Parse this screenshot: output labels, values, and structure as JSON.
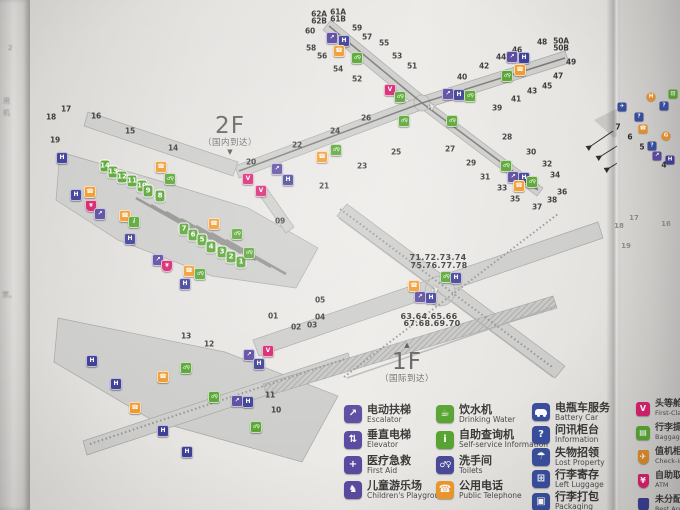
{
  "floors": {
    "f2": {
      "label": "2F",
      "subtitle": "（国内到达）",
      "pointer": "▼"
    },
    "f1": {
      "label": "1F",
      "subtitle": "（国际到达）",
      "pointer": "▲"
    }
  },
  "map_2f": {
    "gates": [
      {
        "n": "62A",
        "x": 319,
        "y": 14
      },
      {
        "n": "62B",
        "x": 319,
        "y": 21
      },
      {
        "n": "61A",
        "x": 338,
        "y": 12
      },
      {
        "n": "61B",
        "x": 338,
        "y": 19
      },
      {
        "n": "60",
        "x": 310,
        "y": 31
      },
      {
        "n": "59",
        "x": 357,
        "y": 28
      },
      {
        "n": "58",
        "x": 311,
        "y": 48
      },
      {
        "n": "57",
        "x": 367,
        "y": 37
      },
      {
        "n": "56",
        "x": 322,
        "y": 56
      },
      {
        "n": "55",
        "x": 384,
        "y": 43
      },
      {
        "n": "54",
        "x": 338,
        "y": 69
      },
      {
        "n": "53",
        "x": 397,
        "y": 56
      },
      {
        "n": "52",
        "x": 357,
        "y": 79
      },
      {
        "n": "51",
        "x": 412,
        "y": 66
      },
      {
        "n": "50A",
        "x": 561,
        "y": 41
      },
      {
        "n": "50B",
        "x": 561,
        "y": 48
      },
      {
        "n": "49",
        "x": 571,
        "y": 62
      },
      {
        "n": "48",
        "x": 542,
        "y": 42
      },
      {
        "n": "47",
        "x": 558,
        "y": 76
      },
      {
        "n": "46",
        "x": 517,
        "y": 50
      },
      {
        "n": "45",
        "x": 547,
        "y": 86
      },
      {
        "n": "44",
        "x": 501,
        "y": 57
      },
      {
        "n": "43",
        "x": 532,
        "y": 91
      },
      {
        "n": "42",
        "x": 484,
        "y": 66
      },
      {
        "n": "41",
        "x": 516,
        "y": 99
      },
      {
        "n": "40",
        "x": 462,
        "y": 77
      },
      {
        "n": "39",
        "x": 497,
        "y": 108
      },
      {
        "n": "26",
        "x": 366,
        "y": 118
      },
      {
        "n": "27",
        "x": 450,
        "y": 149
      },
      {
        "n": "28",
        "x": 507,
        "y": 137
      },
      {
        "n": "29",
        "x": 471,
        "y": 163
      },
      {
        "n": "30",
        "x": 531,
        "y": 152
      },
      {
        "n": "31",
        "x": 485,
        "y": 177
      },
      {
        "n": "32",
        "x": 547,
        "y": 164
      },
      {
        "n": "33",
        "x": 502,
        "y": 188
      },
      {
        "n": "34",
        "x": 555,
        "y": 175
      },
      {
        "n": "35",
        "x": 515,
        "y": 199
      },
      {
        "n": "36",
        "x": 562,
        "y": 192
      },
      {
        "n": "37",
        "x": 537,
        "y": 207
      },
      {
        "n": "38",
        "x": 552,
        "y": 200
      },
      {
        "n": "18",
        "x": 51,
        "y": 117
      },
      {
        "n": "17",
        "x": 66,
        "y": 109
      },
      {
        "n": "16",
        "x": 96,
        "y": 116
      },
      {
        "n": "15",
        "x": 130,
        "y": 131
      },
      {
        "n": "14",
        "x": 173,
        "y": 148
      },
      {
        "n": "19",
        "x": 55,
        "y": 140
      },
      {
        "n": "20",
        "x": 251,
        "y": 162
      },
      {
        "n": "21",
        "x": 324,
        "y": 186
      },
      {
        "n": "22",
        "x": 297,
        "y": 145
      },
      {
        "n": "23",
        "x": 362,
        "y": 166
      },
      {
        "n": "24",
        "x": 335,
        "y": 131
      },
      {
        "n": "25",
        "x": 396,
        "y": 152
      },
      {
        "n": "09",
        "x": 280,
        "y": 221
      }
    ],
    "terminal_gates": [
      {
        "n": "14",
        "x": 105,
        "y": 166
      },
      {
        "n": "13",
        "x": 113,
        "y": 172
      },
      {
        "n": "12",
        "x": 122,
        "y": 177
      },
      {
        "n": "11",
        "x": 132,
        "y": 181
      },
      {
        "n": "10",
        "x": 142,
        "y": 186
      },
      {
        "n": "9",
        "x": 148,
        "y": 191
      },
      {
        "n": "8",
        "x": 160,
        "y": 196
      },
      {
        "n": "7",
        "x": 184,
        "y": 229
      },
      {
        "n": "6",
        "x": 193,
        "y": 235
      },
      {
        "n": "5",
        "x": 202,
        "y": 240
      },
      {
        "n": "4",
        "x": 211,
        "y": 247
      },
      {
        "n": "3",
        "x": 222,
        "y": 252
      },
      {
        "n": "2",
        "x": 231,
        "y": 257
      },
      {
        "n": "1",
        "x": 241,
        "y": 262
      }
    ],
    "icons": [
      {
        "t": "escalator",
        "x": 332,
        "y": 38
      },
      {
        "t": "elevator",
        "x": 344,
        "y": 41
      },
      {
        "t": "phone",
        "x": 339,
        "y": 51
      },
      {
        "t": "toilet",
        "x": 357,
        "y": 58
      },
      {
        "t": "v",
        "x": 390,
        "y": 90
      },
      {
        "t": "toilet",
        "x": 400,
        "y": 97
      },
      {
        "t": "escalator",
        "x": 448,
        "y": 94
      },
      {
        "t": "elevator",
        "x": 459,
        "y": 95
      },
      {
        "t": "toilet",
        "x": 470,
        "y": 96
      },
      {
        "t": "toilet",
        "x": 404,
        "y": 121
      },
      {
        "t": "toilet",
        "x": 452,
        "y": 121
      },
      {
        "t": "plane",
        "x": 432,
        "y": 108
      },
      {
        "t": "escalator",
        "x": 512,
        "y": 57
      },
      {
        "t": "elevator",
        "x": 524,
        "y": 58
      },
      {
        "t": "phone",
        "x": 520,
        "y": 70
      },
      {
        "t": "toilet",
        "x": 507,
        "y": 76
      },
      {
        "t": "toilet",
        "x": 506,
        "y": 166
      },
      {
        "t": "escalator",
        "x": 513,
        "y": 177
      },
      {
        "t": "elevator",
        "x": 524,
        "y": 178
      },
      {
        "t": "phone",
        "x": 519,
        "y": 186
      },
      {
        "t": "toilet",
        "x": 532,
        "y": 182
      },
      {
        "t": "phone",
        "x": 322,
        "y": 157
      },
      {
        "t": "toilet",
        "x": 336,
        "y": 150
      },
      {
        "t": "escalator",
        "x": 277,
        "y": 169
      },
      {
        "t": "elevator",
        "x": 288,
        "y": 180
      },
      {
        "t": "v",
        "x": 248,
        "y": 179
      },
      {
        "t": "v",
        "x": 261,
        "y": 191
      },
      {
        "t": "elevator",
        "x": 62,
        "y": 158
      },
      {
        "t": "phone",
        "x": 161,
        "y": 167
      },
      {
        "t": "toilet",
        "x": 170,
        "y": 179
      },
      {
        "t": "elevator",
        "x": 76,
        "y": 195
      },
      {
        "t": "phone",
        "x": 90,
        "y": 192
      },
      {
        "t": "atm",
        "x": 91,
        "y": 206
      },
      {
        "t": "escalator",
        "x": 100,
        "y": 214
      },
      {
        "t": "phone",
        "x": 125,
        "y": 216
      },
      {
        "t": "info",
        "x": 134,
        "y": 222
      },
      {
        "t": "elevator",
        "x": 130,
        "y": 239
      },
      {
        "t": "phone",
        "x": 214,
        "y": 224
      },
      {
        "t": "toilet",
        "x": 237,
        "y": 234
      },
      {
        "t": "escalator",
        "x": 158,
        "y": 260
      },
      {
        "t": "atm",
        "x": 167,
        "y": 266
      },
      {
        "t": "phone",
        "x": 189,
        "y": 271
      },
      {
        "t": "toilet",
        "x": 200,
        "y": 274
      },
      {
        "t": "elevator",
        "x": 185,
        "y": 284
      },
      {
        "t": "toilet",
        "x": 249,
        "y": 253
      }
    ]
  },
  "map_1f": {
    "stands": [
      {
        "n": "01",
        "x": 273,
        "y": 316
      },
      {
        "n": "02",
        "x": 296,
        "y": 327
      },
      {
        "n": "03",
        "x": 312,
        "y": 325
      },
      {
        "n": "04",
        "x": 320,
        "y": 317
      },
      {
        "n": "05",
        "x": 320,
        "y": 300
      },
      {
        "n": "13",
        "x": 186,
        "y": 336
      },
      {
        "n": "12",
        "x": 209,
        "y": 344
      },
      {
        "n": "11",
        "x": 270,
        "y": 395
      },
      {
        "n": "10",
        "x": 276,
        "y": 410
      }
    ],
    "satellite_gate_labels": [
      {
        "t": "71.72.73.74",
        "x": 438,
        "y": 258
      },
      {
        "t": "75.76.77.78",
        "x": 439,
        "y": 266
      },
      {
        "t": "63.64.65.66",
        "x": 429,
        "y": 317
      },
      {
        "t": "67.68.69.70",
        "x": 432,
        "y": 324
      }
    ],
    "icons": [
      {
        "t": "elevator",
        "x": 92,
        "y": 361
      },
      {
        "t": "elevator",
        "x": 116,
        "y": 384
      },
      {
        "t": "toilet",
        "x": 186,
        "y": 368
      },
      {
        "t": "phone",
        "x": 163,
        "y": 377
      },
      {
        "t": "phone",
        "x": 135,
        "y": 408
      },
      {
        "t": "escalator",
        "x": 249,
        "y": 355
      },
      {
        "t": "v",
        "x": 268,
        "y": 351
      },
      {
        "t": "elevator",
        "x": 259,
        "y": 364
      },
      {
        "t": "toilet",
        "x": 214,
        "y": 397
      },
      {
        "t": "escalator",
        "x": 237,
        "y": 401
      },
      {
        "t": "elevator",
        "x": 248,
        "y": 402
      },
      {
        "t": "toilet",
        "x": 256,
        "y": 427
      },
      {
        "t": "elevator",
        "x": 163,
        "y": 431
      },
      {
        "t": "elevator",
        "x": 187,
        "y": 452
      },
      {
        "t": "phone",
        "x": 414,
        "y": 286
      },
      {
        "t": "escalator",
        "x": 420,
        "y": 297
      },
      {
        "t": "elevator",
        "x": 431,
        "y": 298
      },
      {
        "t": "toilet",
        "x": 446,
        "y": 277
      },
      {
        "t": "elevator",
        "x": 456,
        "y": 278
      },
      {
        "t": "plane",
        "x": 436,
        "y": 291
      }
    ]
  },
  "legend": {
    "columns": [
      {
        "x": 344,
        "y": 404,
        "gap": 5,
        "items": [
          {
            "zh": "电动扶梯",
            "en": "Escalator",
            "icon": "escalator",
            "color": "#5b4aa0",
            "shape": "square"
          },
          {
            "zh": "垂直电梯",
            "en": "Elevator",
            "icon": "elevator",
            "color": "#5b4aa0",
            "shape": "square"
          },
          {
            "zh": "医疗急救",
            "en": "First Aid",
            "icon": "first-aid",
            "color": "#5b4aa0",
            "shape": "square"
          },
          {
            "zh": "儿童游乐场",
            "en": "Children's Playground",
            "icon": "playground",
            "color": "#5b4aa0",
            "shape": "square"
          }
        ]
      },
      {
        "x": 436,
        "y": 404,
        "gap": 5,
        "items": [
          {
            "zh": "饮水机",
            "en": "Drinking Water",
            "icon": "drinking-water",
            "color": "#58a433",
            "shape": "square"
          },
          {
            "zh": "自助查询机",
            "en": "Self-service Information",
            "icon": "self-service-info",
            "color": "#58a433",
            "shape": "square"
          },
          {
            "zh": "洗手间",
            "en": "Toilets",
            "icon": "toilets",
            "color": "#4a4a9a",
            "shape": "square"
          },
          {
            "zh": "公用电话",
            "en": "Public Telephone",
            "icon": "telephone",
            "color": "#f09a2e",
            "shape": "square"
          }
        ]
      },
      {
        "x": 532,
        "y": 402,
        "gap": 2,
        "items": [
          {
            "zh": "电瓶车服务",
            "en": "Battery Car",
            "icon": "battery-car",
            "color": "#3a4f9e",
            "shape": "square"
          },
          {
            "zh": "问讯柜台",
            "en": "Information",
            "icon": "information",
            "color": "#3a4f9e",
            "shape": "square"
          },
          {
            "zh": "失物招领",
            "en": "Lost Property",
            "icon": "lost-property",
            "color": "#3a4f9e",
            "shape": "square"
          },
          {
            "zh": "行李寄存",
            "en": "Left Luggage",
            "icon": "left-luggage",
            "color": "#3a4f9e",
            "shape": "square"
          },
          {
            "zh": "行李打包",
            "en": "Packaging",
            "icon": "packaging",
            "color": "#3a4f9e",
            "shape": "square"
          }
        ]
      }
    ],
    "right_fold_column": {
      "x": 636,
      "y": 400,
      "gap": 7,
      "items": [
        {
          "zh": "头等舱或商",
          "en": "First-Class/Busi",
          "icon": "v-badge",
          "color": "#d6216e",
          "shape": "square"
        },
        {
          "zh": "行李提取",
          "en": "Baggage Cla",
          "icon": "baggage-claim",
          "color": "#58a433",
          "shape": "square"
        },
        {
          "zh": "值机柜台",
          "en": "Check-in Co",
          "icon": "check-in",
          "color": "#d98a2b",
          "shape": "shield"
        },
        {
          "zh": "自助取款机",
          "en": "ATM",
          "icon": "atm",
          "color": "#d6216e",
          "shape": "shield"
        },
        {
          "zh": "未分配登机",
          "en": "Rest Area for",
          "icon": "rest-area",
          "color": "#3a3f8f",
          "shape": "shield"
        }
      ]
    }
  },
  "right_fold_map": {
    "arrow_numbers": [
      {
        "n": "7",
        "x": 618,
        "y": 127
      },
      {
        "n": "6",
        "x": 630,
        "y": 137
      },
      {
        "n": "5",
        "x": 642,
        "y": 147
      },
      {
        "n": "4",
        "x": 664,
        "y": 165
      }
    ],
    "faint_gates": [
      {
        "n": "18",
        "x": 619,
        "y": 226
      },
      {
        "n": "17",
        "x": 634,
        "y": 218
      },
      {
        "n": "16",
        "x": 666,
        "y": 224
      },
      {
        "n": "19",
        "x": 626,
        "y": 246
      }
    ],
    "mini_icons": [
      {
        "g": "H",
        "c": "#e8912d",
        "x": 651,
        "y": 97,
        "round": true
      },
      {
        "g": "?",
        "c": "#3a4f9e",
        "x": 664,
        "y": 106
      },
      {
        "g": "✈",
        "c": "#3a4f9e",
        "x": 622,
        "y": 107
      },
      {
        "g": "?",
        "c": "#3a4f9e",
        "x": 639,
        "y": 117
      },
      {
        "g": "☎",
        "c": "#e8912d",
        "x": 643,
        "y": 129
      },
      {
        "g": "G",
        "c": "#e8912d",
        "x": 666,
        "y": 136,
        "round": true
      },
      {
        "g": "?",
        "c": "#3a4f9e",
        "x": 652,
        "y": 146
      },
      {
        "g": "↗",
        "c": "#5b4aa0",
        "x": 657,
        "y": 156
      },
      {
        "g": "▥",
        "c": "#58a433",
        "x": 673,
        "y": 94
      },
      {
        "g": "H",
        "c": "#3f3f96",
        "x": 670,
        "y": 160
      }
    ]
  },
  "left_fold_fragments": [
    {
      "t": "2",
      "x": 8,
      "y": 44
    },
    {
      "t": "用",
      "x": 3,
      "y": 96
    },
    {
      "t": "机",
      "x": 3,
      "y": 108
    },
    {
      "t": "票。",
      "x": 2,
      "y": 290
    }
  ]
}
